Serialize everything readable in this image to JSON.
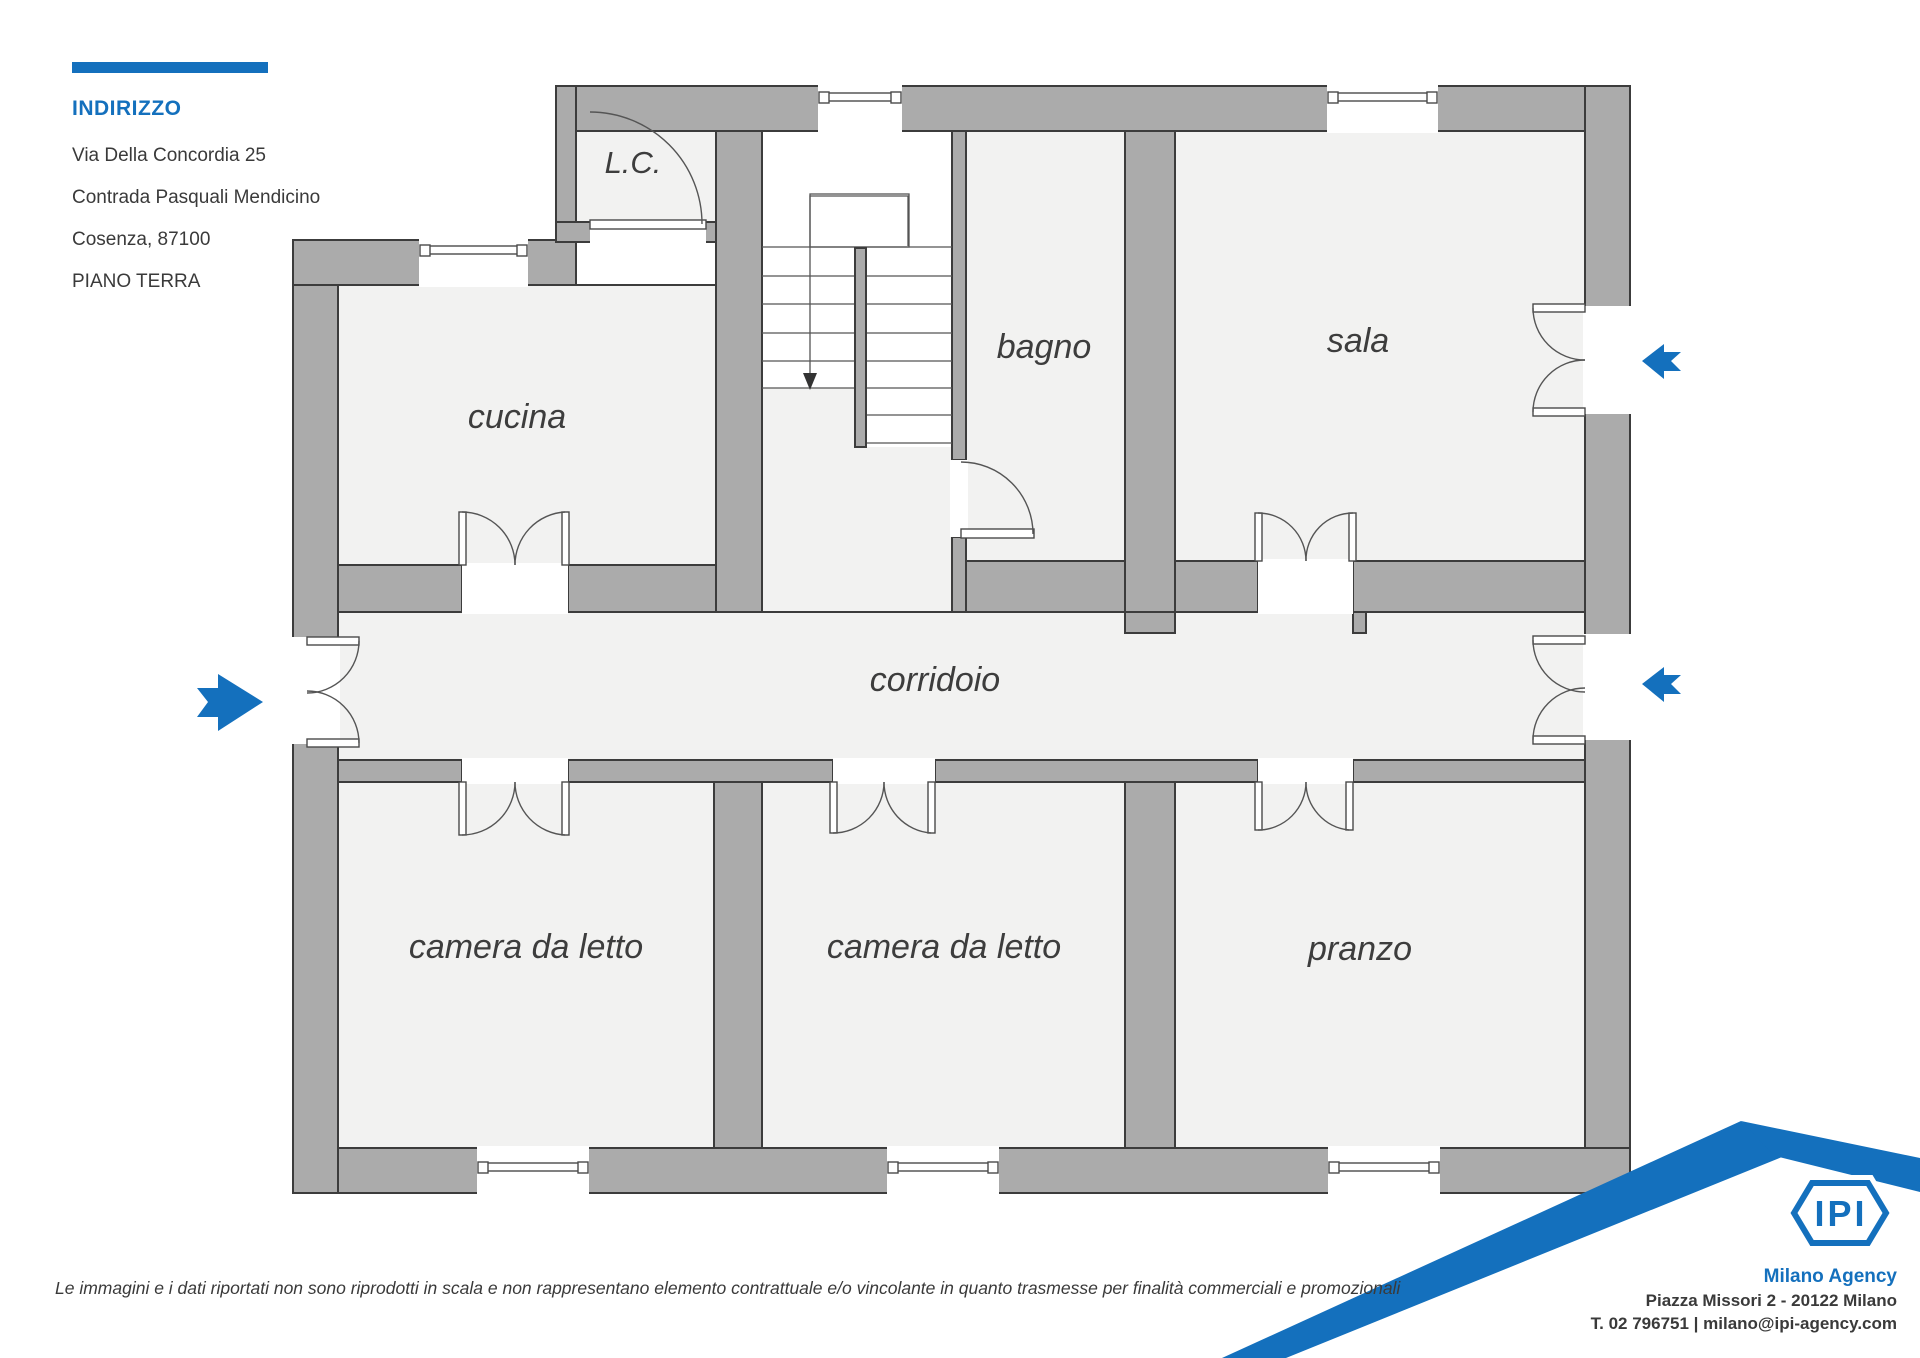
{
  "colors": {
    "accent_blue": "#1470bd",
    "wall_fill": "#ababab",
    "wall_outline": "#3c3c3c",
    "room_floor": "#f2f2f1",
    "text": "#3a3a3a"
  },
  "address": {
    "heading": "INDIRIZZO",
    "line1": "Via Della Concordia 25",
    "line2": "Contrada Pasquali Mendicino",
    "line3": "Cosenza, 87100",
    "floor_label": "PIANO TERRA"
  },
  "rooms": {
    "lc": "L.C.",
    "cucina": "cucina",
    "bagno": "bagno",
    "sala": "sala",
    "corridoio": "corridoio",
    "camera1": "camera da letto",
    "camera2": "camera da letto",
    "pranzo": "pranzo"
  },
  "icons": {
    "entrance_arrow": "right-arrow",
    "side_arrows": "left-arrow"
  },
  "disclaimer": "Le immagini e i dati riportati non sono riprodotti in scala e non rappresentano elemento contrattuale e/o vincolante in quanto trasmesse per finalità commerciali e promozionali",
  "agency": {
    "logo_text": "IPI",
    "name": "Milano Agency",
    "address_line": "Piazza Missori 2 - 20122 Milano",
    "contact_line": "T. 02 796751 | milano@ipi-agency.com"
  }
}
